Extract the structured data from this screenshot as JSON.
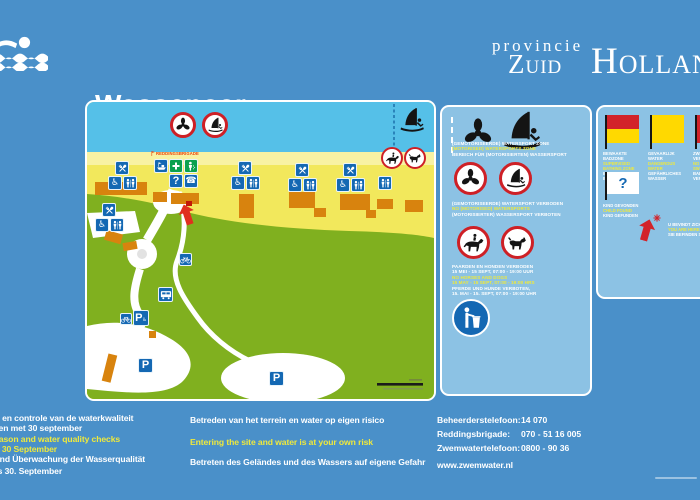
{
  "header": {
    "title_line1": "Wassenaar",
    "title_line2": "3  Wassenaarse Slag",
    "province_prefix": "provincie",
    "province_word1": "Zuid",
    "province_word2": "Holland"
  },
  "map": {
    "lifeguard_label": "REDDINGSBRIGADE",
    "glyphs": {
      "parking": "P",
      "question": "?",
      "phone": "☎",
      "wheelchair": "♿"
    }
  },
  "middle_panel": {
    "zone": {
      "nl": "(GEMOTORISEERDE) WATERSPORT ZONE",
      "en": "(MOTORISED) WATERSPORTS ZONE",
      "de": "BEREICH FÜR (MOTORISIERTEN) WASSERSPORT"
    },
    "prohibited": {
      "nl": "(GEMOTORISEERDE) WATERSPORT VERBODEN",
      "en": "NO (MOTORISED) WATERSPORTS",
      "de": "(MOTORISIERTER) WASSERSPORT VERBOTEN"
    },
    "horses_dogs": {
      "nl1": "PAARDEN EN HONDEN VERBODEN",
      "nl2": "15 MEI - 15 SEPT, 07:00 - 19:00 UUR",
      "en1": "NO HORSES AND DOGS",
      "en2": "15 MAY - 15 SEPT, 07:00 - 19:00 HRS",
      "de1": "PFERDE UND HUNDE VERBOTEN,",
      "de2": "15. MAI - 15. SEPT, 07:00 - 19:00 UHR"
    }
  },
  "right_panel": {
    "flag_supervised": {
      "l1": "BEWAAKTE",
      "l2": "BADZONE",
      "l3": "SUPERVISED",
      "l4": "BATHING ZONE",
      "l5": "BEWACHTE",
      "l6": "BADEZONE"
    },
    "flag_danger": {
      "l1": "GEVAARLIJK",
      "l2": "WATER",
      "l3": "DANGEROUS",
      "l4": "WATER",
      "l5": "GEFÄHRLICHES",
      "l6": "WASSER"
    },
    "flag_noswim": {
      "l1": "ZWEMMEN",
      "l2": "VERBODEN",
      "l3": "NO",
      "l4": "SWIMMING",
      "l5": "BADEN",
      "l6": "VERBOTEN"
    },
    "child_found": {
      "nl": "KIND GEVONDEN",
      "en": "CHILD FOUND",
      "de": "KIND GEFUNDEN"
    },
    "you_are_here": {
      "nl": "U BEVINDT ZICH HIER",
      "en": "YOU ARE HERE",
      "de": "SIE BEFINDEN SICH HIER"
    }
  },
  "footer": {
    "col1": [
      "Zwemseizoen en controle van de waterkwaliteit",
      "van 1 mei tot en met 30 september",
      "Swimming season and water quality checks",
      "from 1 May to 30 September",
      "Badesaison und Überwachung der Wasserqualität",
      "vom 1. Mai bis 30. September"
    ],
    "col2": [
      "Betreden van het terrein en water op eigen risico",
      "Entering the site and water is at your own risk",
      "Betreten des Geländes und des Wassers auf eigene Gefahr"
    ],
    "contacts": [
      {
        "label": "Beheerderstelefoon:",
        "value": "14 070"
      },
      {
        "label": "Reddingsbrigade:",
        "value": "070 - 51 16 005"
      },
      {
        "label": "Zwemwatertelefoon:",
        "value": "0800 - 90 36"
      }
    ],
    "website": "www.zwemwater.nl"
  },
  "colors": {
    "background": "#4A90C9",
    "panel_blue": "#8CC2E4",
    "sea": "#55C0E8",
    "sand": "#F2E85C",
    "dunes": "#80B01F",
    "building_orange": "#D8830E",
    "sign_blue": "#1468B3",
    "sign_green": "#0AA14E",
    "prohibition_red": "#CE2026",
    "accent_yellow": "#EFE93C",
    "flag_red": "#D2232A",
    "flag_yellow": "#FFD900"
  }
}
